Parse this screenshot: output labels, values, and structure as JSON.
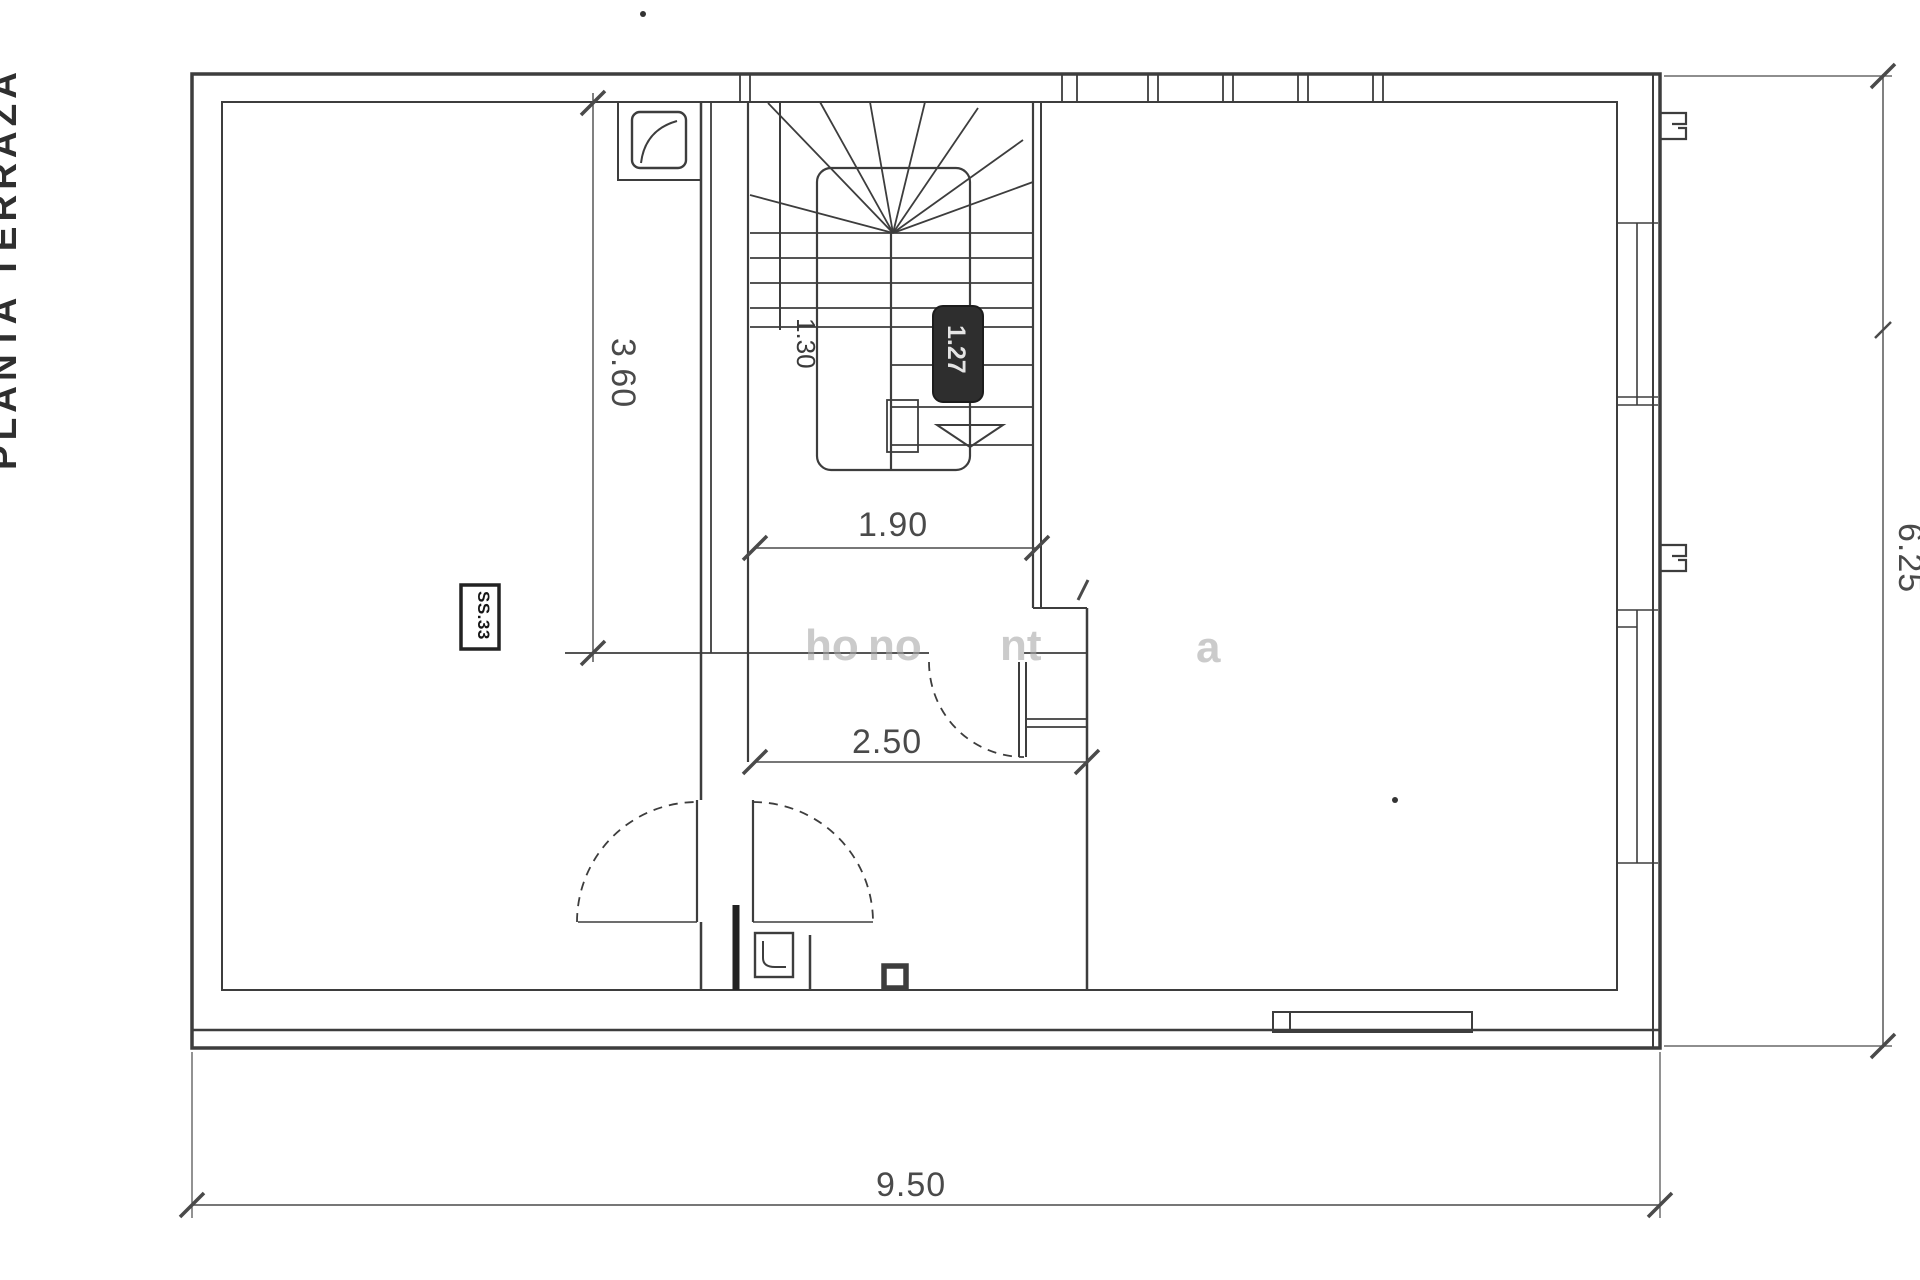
{
  "page": {
    "background": "#ffffff",
    "ink": "#3d3d3d"
  },
  "side_label": {
    "text": "PLANTA TERRAZA"
  },
  "dimensions": {
    "width_total": "9.50",
    "height_total": "6.25",
    "hall_depth": "3.60",
    "stair_width": "1.90",
    "hall_width": "2.50",
    "stair_flight": "1.30",
    "stair_badge": "1.27",
    "room_badge": "SS.33"
  },
  "watermark": {
    "fragments": [
      {
        "text": "ho"
      },
      {
        "text": "no"
      },
      {
        "text": "nt"
      },
      {
        "text": "a"
      }
    ]
  }
}
